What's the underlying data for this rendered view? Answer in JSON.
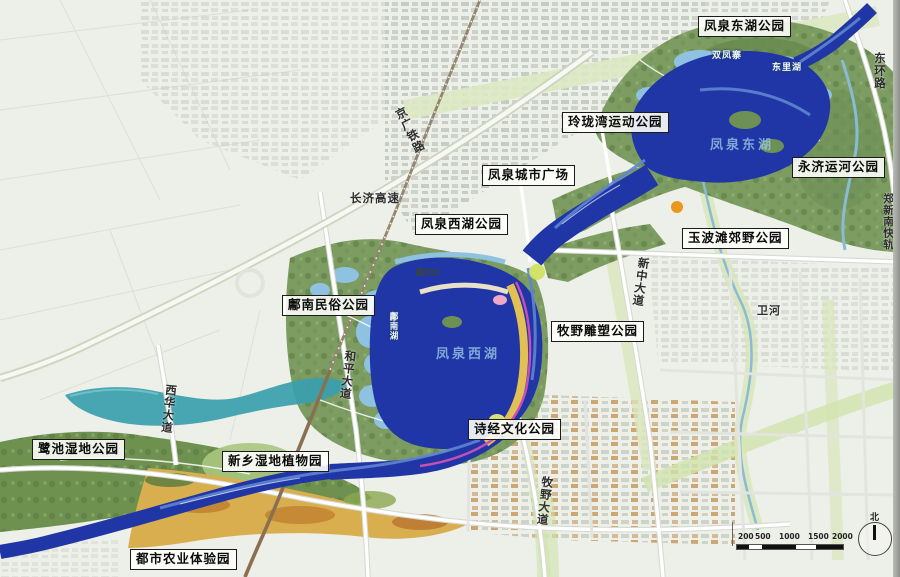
{
  "parks": [
    {
      "id": "fengquan-east-lake-park",
      "label": "凤泉东湖公园"
    },
    {
      "id": "linglong-bay-sports-park",
      "label": "玲珑湾运动公园"
    },
    {
      "id": "fengquan-city-plaza",
      "label": "凤泉城市广场"
    },
    {
      "id": "fengquan-west-lake-park",
      "label": "凤泉西湖公园"
    },
    {
      "id": "yongji-canal-park",
      "label": "永济运河公园"
    },
    {
      "id": "yubotan-country-park",
      "label": "玉波滩郊野公园"
    },
    {
      "id": "yongnan-folk-park",
      "label": "鄘南民俗公园"
    },
    {
      "id": "muye-sculpture-park",
      "label": "牧野雕塑公园"
    },
    {
      "id": "shijing-culture-park",
      "label": "诗经文化公园"
    },
    {
      "id": "luchi-wetland-park",
      "label": "鹭池湿地公园"
    },
    {
      "id": "xinxiang-wetland-botanic-garden",
      "label": "新乡湿地植物园"
    },
    {
      "id": "urban-agriculture-experience-park",
      "label": "都市农业体验园"
    }
  ],
  "roads": {
    "donghuan_road": "东环路",
    "zhengxin_south_rail": "郑新南快轨",
    "jingguang_railway": "京广铁路",
    "changji_expressway": "长济高速",
    "xinzhong_avenue": "新中大道",
    "heping_avenue": "和平大道",
    "xihua_avenue": "西华大道",
    "muye_avenue": "牧野大道",
    "wei_river": "卫河"
  },
  "features": {
    "shuangfengzhai": "双凤寨",
    "dongli_lake": "东里湖",
    "yongnan_lake": "鄘南湖",
    "yongfeng_terrace": "鄘风台"
  },
  "watermarks": {
    "west_lake": "凤泉西湖",
    "east_lake": "凤泉东湖"
  },
  "scalebar": {
    "ticks": [
      "200",
      "500",
      "1000",
      "1500",
      "2000"
    ]
  },
  "compass": {
    "north": "北"
  },
  "colors": {
    "river_blue": "#2036a6",
    "shallow_blue": "#8fc2e0",
    "wetland_teal": "#39a0ae",
    "park_green": "#7d9c62",
    "field_yellow": "#ddb955",
    "greenway_magenta": "#c84fb5"
  }
}
